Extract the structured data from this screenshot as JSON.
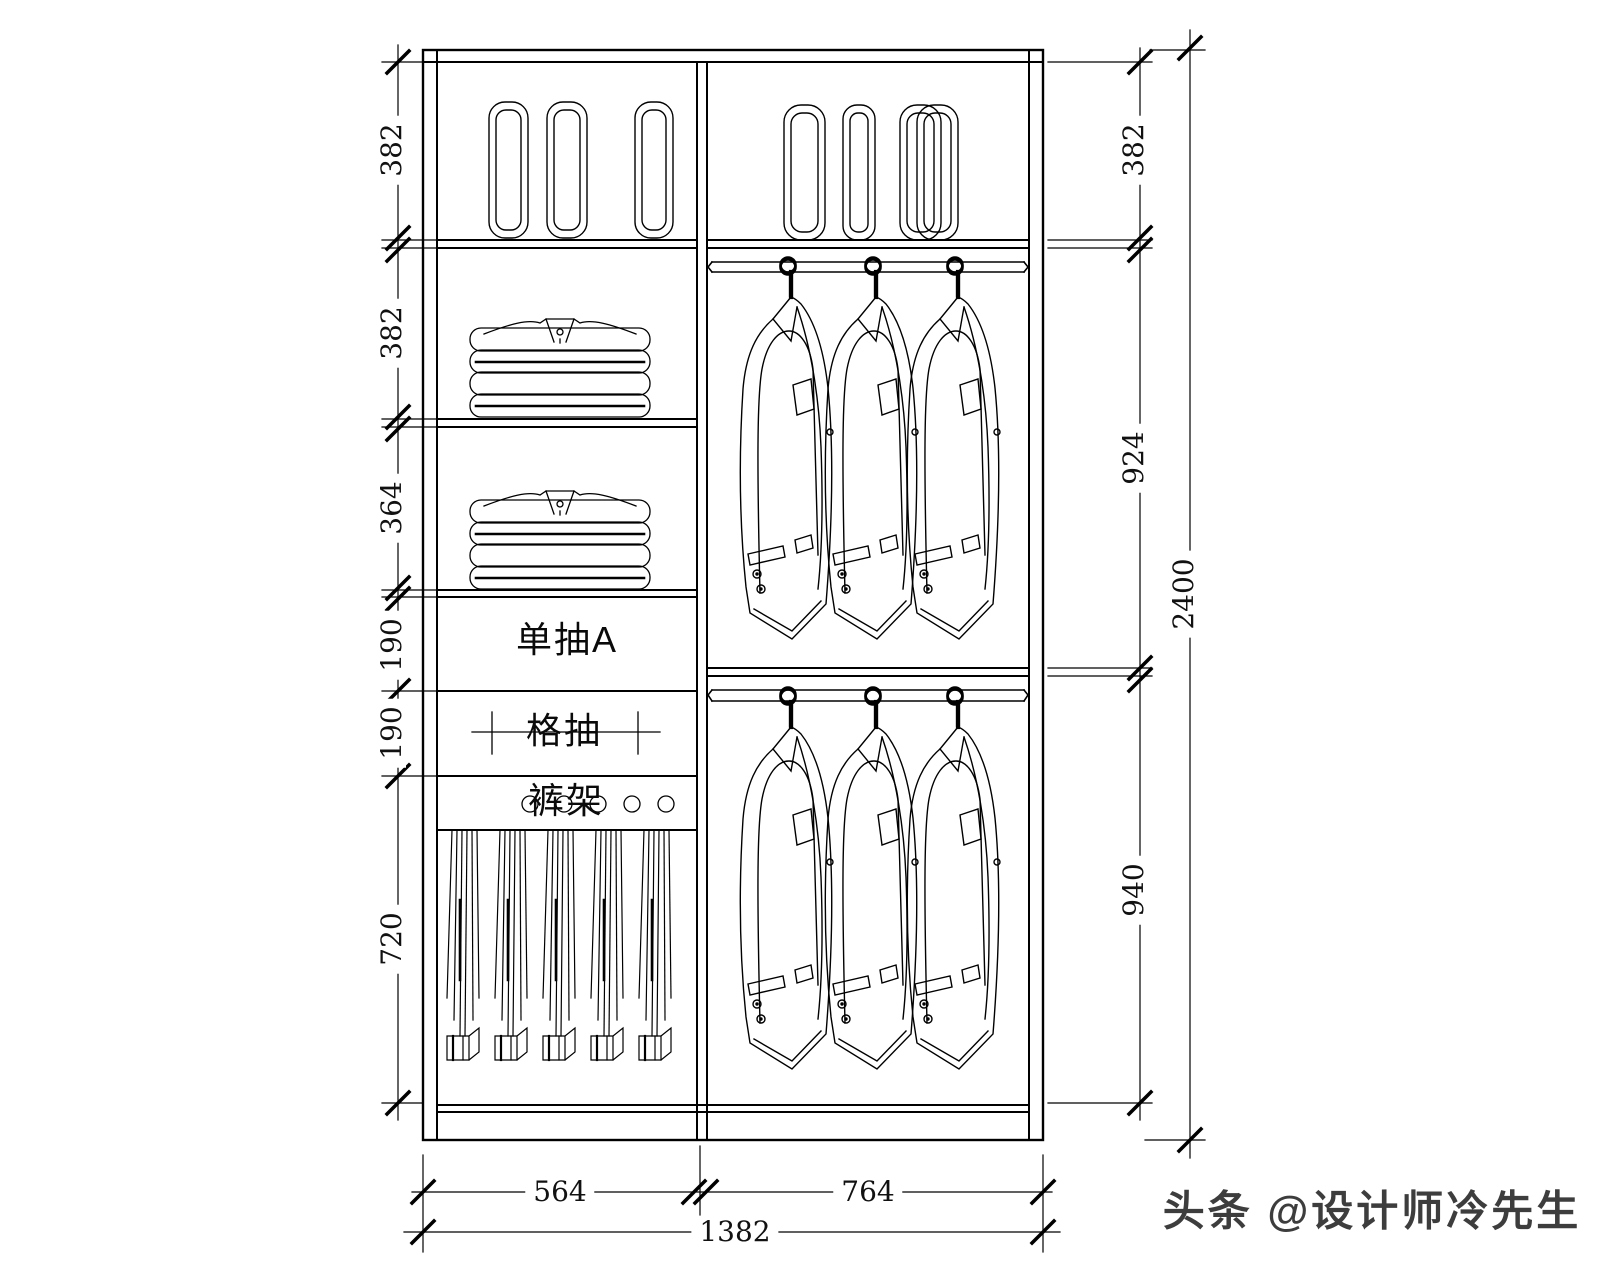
{
  "dims": {
    "left": [
      "382",
      "382",
      "364",
      "190",
      "190",
      "720"
    ],
    "right": [
      "382",
      "924",
      "940"
    ],
    "overall_height": "2400",
    "bottom": [
      "564",
      "764"
    ],
    "overall_width": "1382"
  },
  "labels": {
    "drawer_single": "单抽A",
    "drawer_grid": "格抽",
    "pants_rack": "裤架"
  },
  "watermark": "头条 @设计师冷先生",
  "colors": {
    "line": "#000000",
    "background": "#ffffff",
    "watermark": "#3d3d3d"
  }
}
